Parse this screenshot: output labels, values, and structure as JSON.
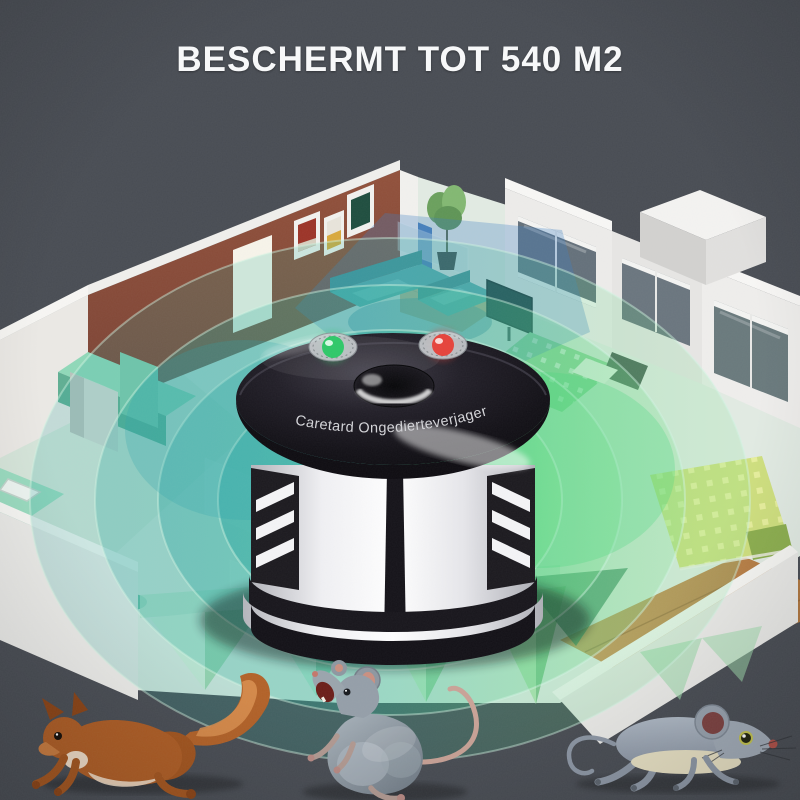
{
  "colors": {
    "background": "#484c53",
    "wave_teal": "#23a39f",
    "wave_green": "#57d57e",
    "led_green": "#2ec868",
    "led_red": "#e6423a",
    "device_top": "#141218",
    "device_body": "#f2f2f4"
  },
  "header": {
    "title": "BESCHERMT TOT 540 M2"
  },
  "device": {
    "brand_label": "Caretard Ongedierteverjager",
    "indicators": [
      {
        "name": "green-led",
        "color_ref": "led_green"
      },
      {
        "name": "red-led",
        "color_ref": "led_red"
      }
    ]
  },
  "scene": {
    "animals": [
      {
        "name": "squirrel"
      },
      {
        "name": "rat"
      },
      {
        "name": "mouse"
      }
    ]
  }
}
